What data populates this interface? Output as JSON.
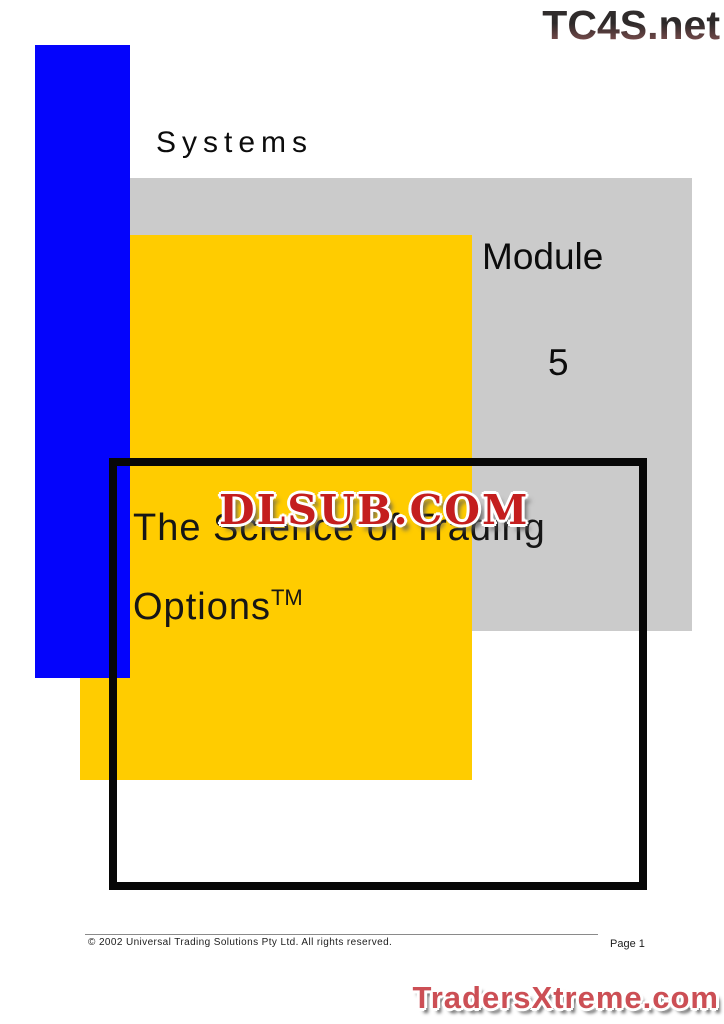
{
  "header": {
    "tc4s_logo": "TC4S.net"
  },
  "cover": {
    "systems_label": "Systems",
    "module_label": "Module",
    "module_number": "5",
    "title_line1": "The Science of Trading",
    "title_line2": "Options",
    "trademark": "TM"
  },
  "watermarks": {
    "dlsub": "DLSUB.COM",
    "tradersxtreme": "TradersXtreme.com"
  },
  "footer": {
    "copyright": "© 2002 Universal Trading Solutions Pty Ltd. All rights reserved.",
    "page_label": "Page 1"
  },
  "colors": {
    "blue_bar": "#0404fc",
    "yellow_block": "#ffcc00",
    "gray_block": "#cbcbcb",
    "frame_black": "#070707",
    "tc4s_dark": "#453a3a",
    "dlsub_red": "#c41e1e",
    "tradersxtreme_red": "#cc4f55"
  }
}
